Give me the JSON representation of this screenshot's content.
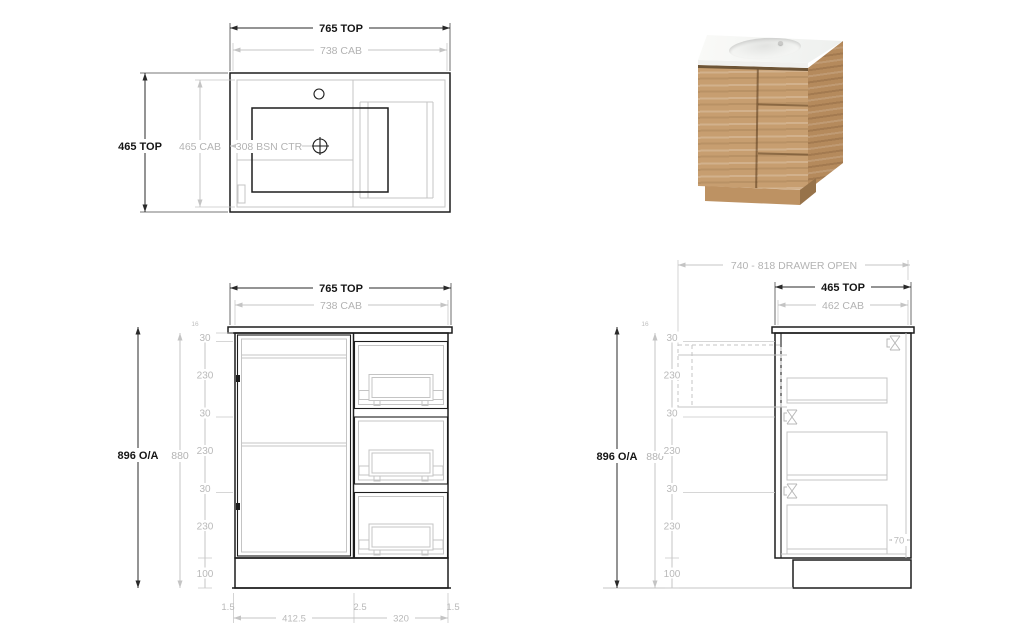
{
  "colors": {
    "line_dark": "#1d1d1d",
    "line_light": "#c4c4c4",
    "text_dark": "#161616",
    "text_light": "#b3b3b3",
    "wood": "#c79e70",
    "wood_side": "#b58a5c",
    "ceramic": "#f6f6f4"
  },
  "views": {
    "plan": {
      "width_top": "765 TOP",
      "width_cab": "738 CAB",
      "depth_top": "465 TOP",
      "depth_cab": "465 CAB",
      "basin_centre": "308 BSN CTR"
    },
    "front": {
      "width_top": "765 TOP",
      "width_cab": "738 CAB",
      "height_overall": "896 O/A",
      "height_cab": "880",
      "top_thickness": "16",
      "height_segments": [
        "30",
        "230",
        "30",
        "230",
        "30",
        "230",
        "100"
      ],
      "width_segments": [
        "1.5",
        "412.5",
        "2.5",
        "320",
        "1.5"
      ]
    },
    "side": {
      "drawer_open": "740 - 818 DRAWER OPEN",
      "depth_top": "465 TOP",
      "depth_cab": "462 CAB",
      "height_overall": "896 O/A",
      "height_cab": "880",
      "top_thickness": "16",
      "height_segments": [
        "30",
        "230",
        "30",
        "230",
        "30",
        "230",
        "100"
      ],
      "back_gap": "70"
    }
  }
}
